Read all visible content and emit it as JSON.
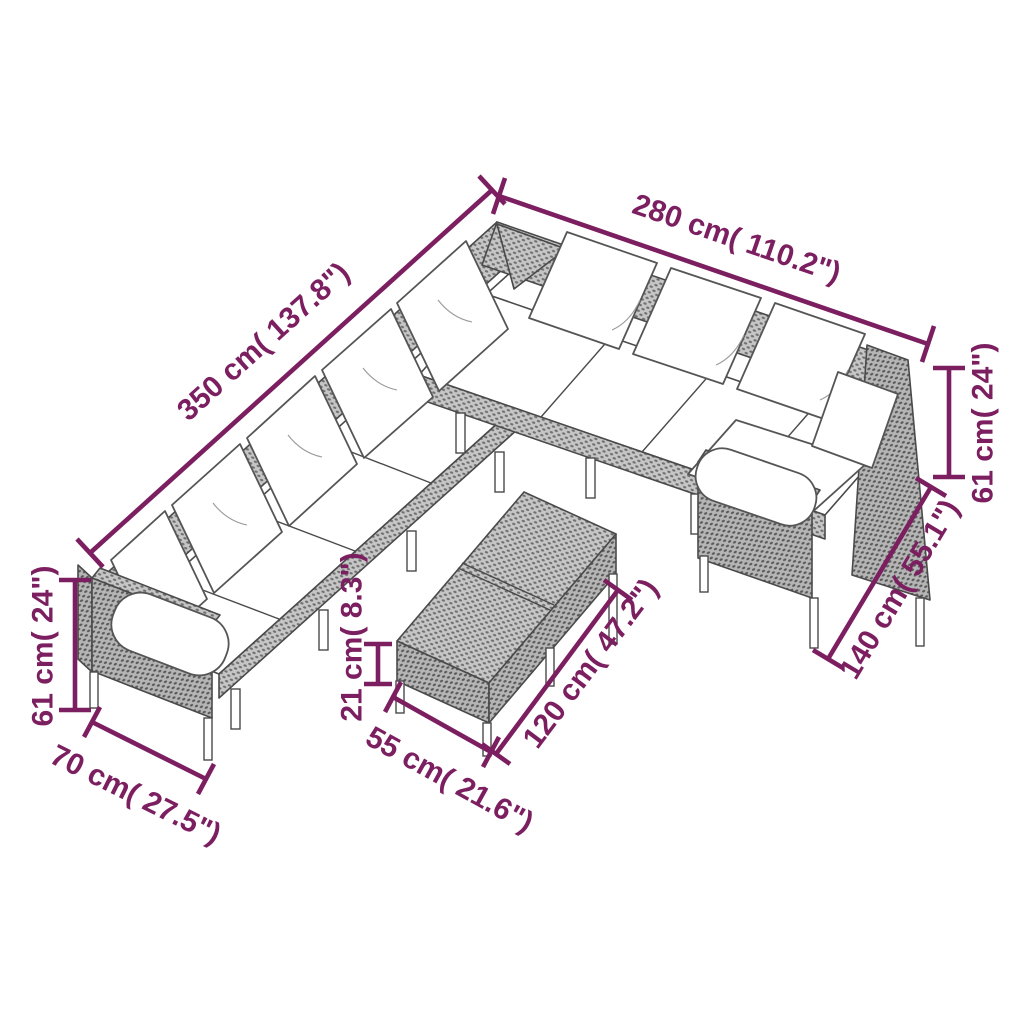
{
  "figure": {
    "type": "product dimension diagram",
    "subject": "poly rattan garden lounge set with cushions and coffee table"
  },
  "dimensions": {
    "sofa_side_long": "350 cm( 137.8\")",
    "sofa_side_wide": "280 cm( 110.2\")",
    "back_height_left": "61 cm( 24\")",
    "back_height_right": "61 cm( 24\")",
    "corner_section_depth": "140 cm( 55.1\")",
    "seat_depth": "70 cm( 27.5\")",
    "table_height": "21 cm( 8.3\")",
    "table_width": "55 cm( 21.6\")",
    "table_length": "120 cm( 47.2\")"
  },
  "style": {
    "dimension_color": "#7C1F60",
    "outline_color": "#4a4a4a",
    "rattan_base": "#c6c6c6",
    "rattan_dot": "#6f6f6f",
    "rattan_dark_base": "#b5b5b5",
    "rattan_dark_dot": "#585858",
    "cushion_color": "#ffffff",
    "background": "#ffffff"
  }
}
